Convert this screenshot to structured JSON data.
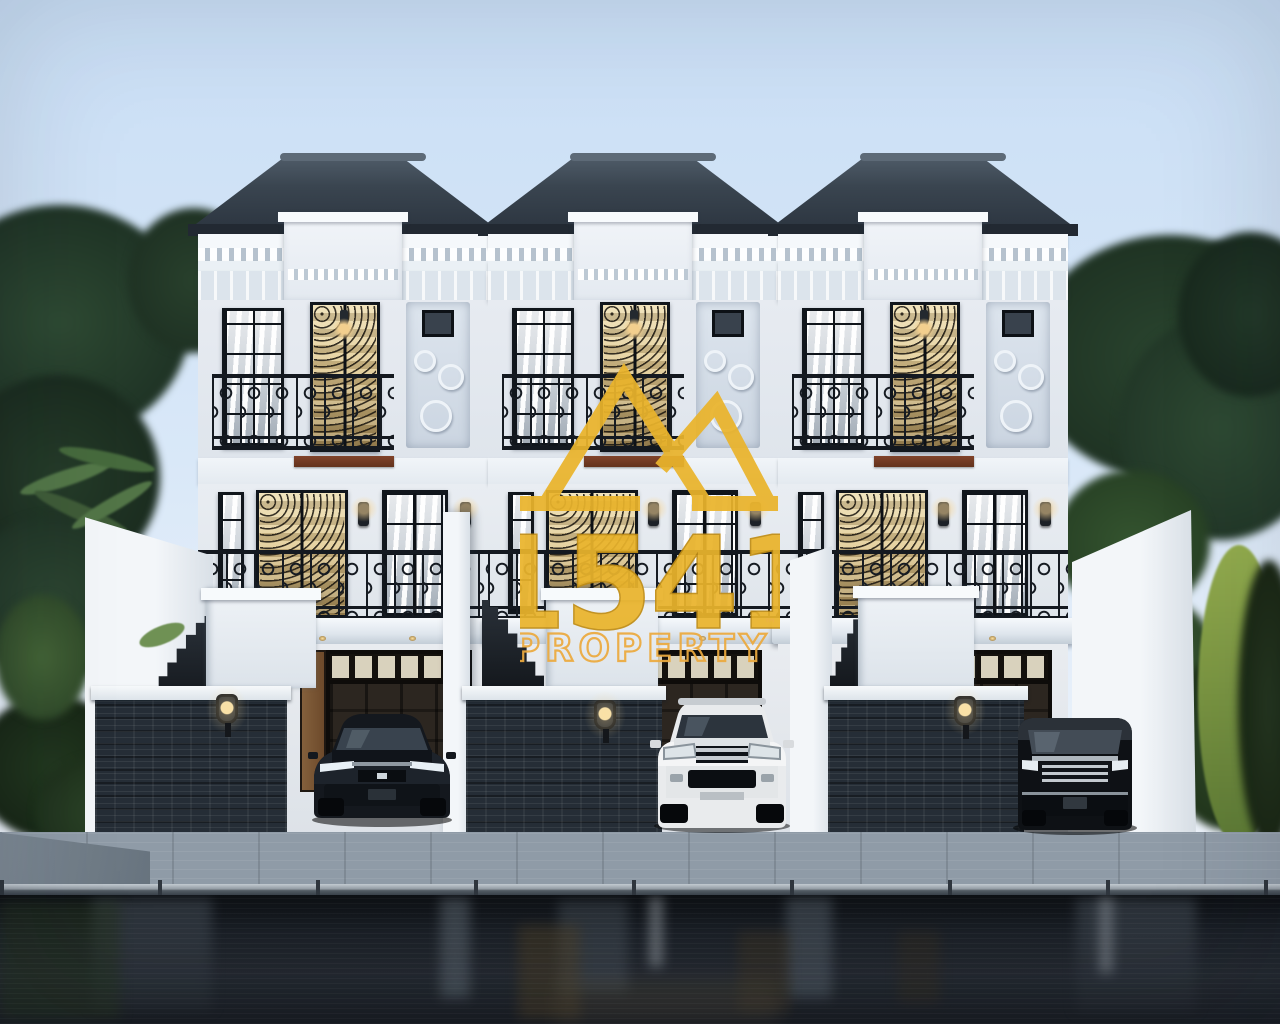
{
  "watermark": {
    "number": "1541",
    "word": "PROPERTY",
    "trademark": "™"
  },
  "colors": {
    "sky_top": "#c9def5",
    "sky_bottom": "#edf3fb",
    "roof": "#38434f",
    "roof_light": "#5d6a77",
    "wall": "#e9edf3",
    "wall_bright": "#f5f8fb",
    "stone": "#252d36",
    "iron": "#161b22",
    "gold": "#eab42c",
    "gold_deep": "#c08d15",
    "gold_outline": "#ecaa3e",
    "wood": "#7b5434",
    "beam": "#80432a",
    "pavement": "#8f9ba7",
    "street": "#171c22",
    "foliage": "#2a4330",
    "glow": "#f3cf8e"
  },
  "scene": {
    "units": [
      {
        "id": "unit-1",
        "vehicle": "black-sedan"
      },
      {
        "id": "unit-2",
        "vehicle": "white-suv"
      },
      {
        "id": "unit-3",
        "vehicle": "black-mpv"
      }
    ]
  }
}
